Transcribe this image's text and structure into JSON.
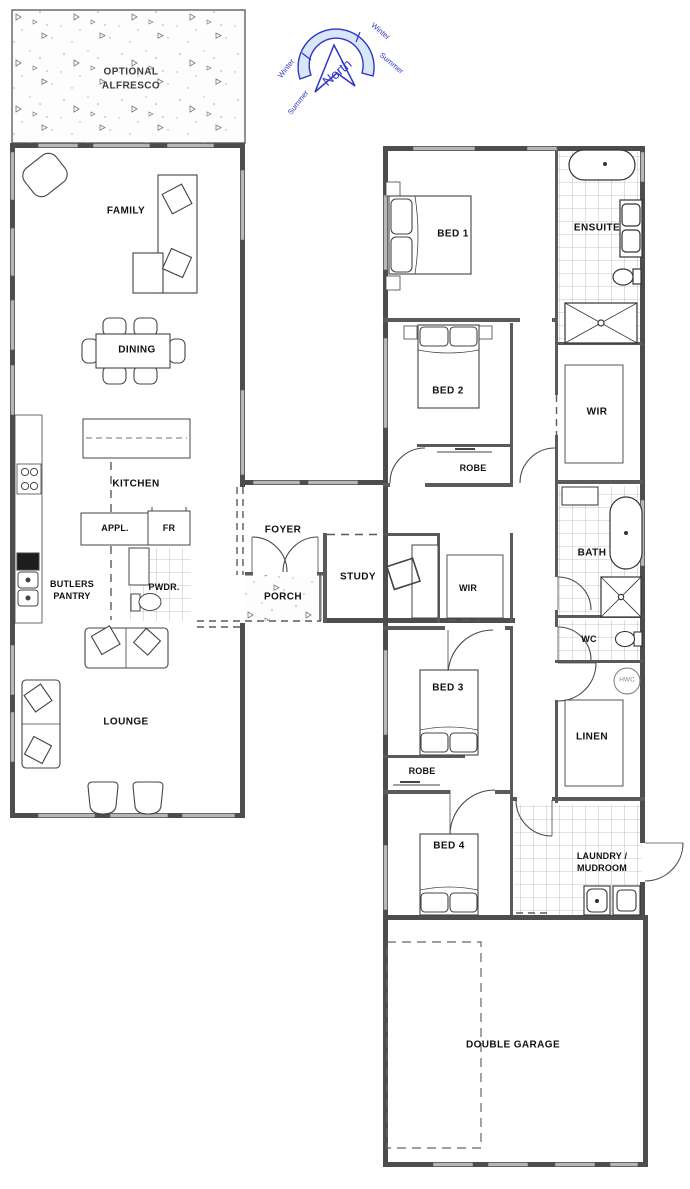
{
  "compass": {
    "north_label": "North",
    "winter_left": "Winter",
    "winter_right": "Winter",
    "summer_left": "Summer",
    "summer_right": "Summer",
    "line_color": "#2d35c8",
    "arc_fill": "#d9e6f5"
  },
  "outdoor": {
    "alfresco": "OPTIONAL\nALFRESCO",
    "porch": "PORCH"
  },
  "rooms": {
    "family": "FAMILY",
    "dining": "DINING",
    "kitchen": "KITCHEN",
    "appliances": "APPL.",
    "fridge": "FR",
    "butlers_pantry": "BUTLERS\nPANTRY",
    "powder": "PWDR.",
    "foyer": "FOYER",
    "study": "STUDY",
    "study_wir": "WIR",
    "lounge": "LOUNGE",
    "bed1": "BED 1",
    "ensuite": "ENSUITE",
    "bed2": "BED 2",
    "bed2_robe": "ROBE",
    "wir": "WIR",
    "bath": "BATH",
    "wc": "WC",
    "hot_water": "HWC",
    "linen": "LINEN",
    "bed3": "BED 3",
    "bed3_robe": "ROBE",
    "bed4": "BED 4",
    "laundry": "LAUNDRY /\nMUDROOM",
    "garage": "DOUBLE GARAGE"
  },
  "colors": {
    "wall": "#4d4d4d",
    "window": "#b7b7b7",
    "furniture": "#3f3f3f",
    "tile": "#949494",
    "dash": "#5a5a5a"
  }
}
